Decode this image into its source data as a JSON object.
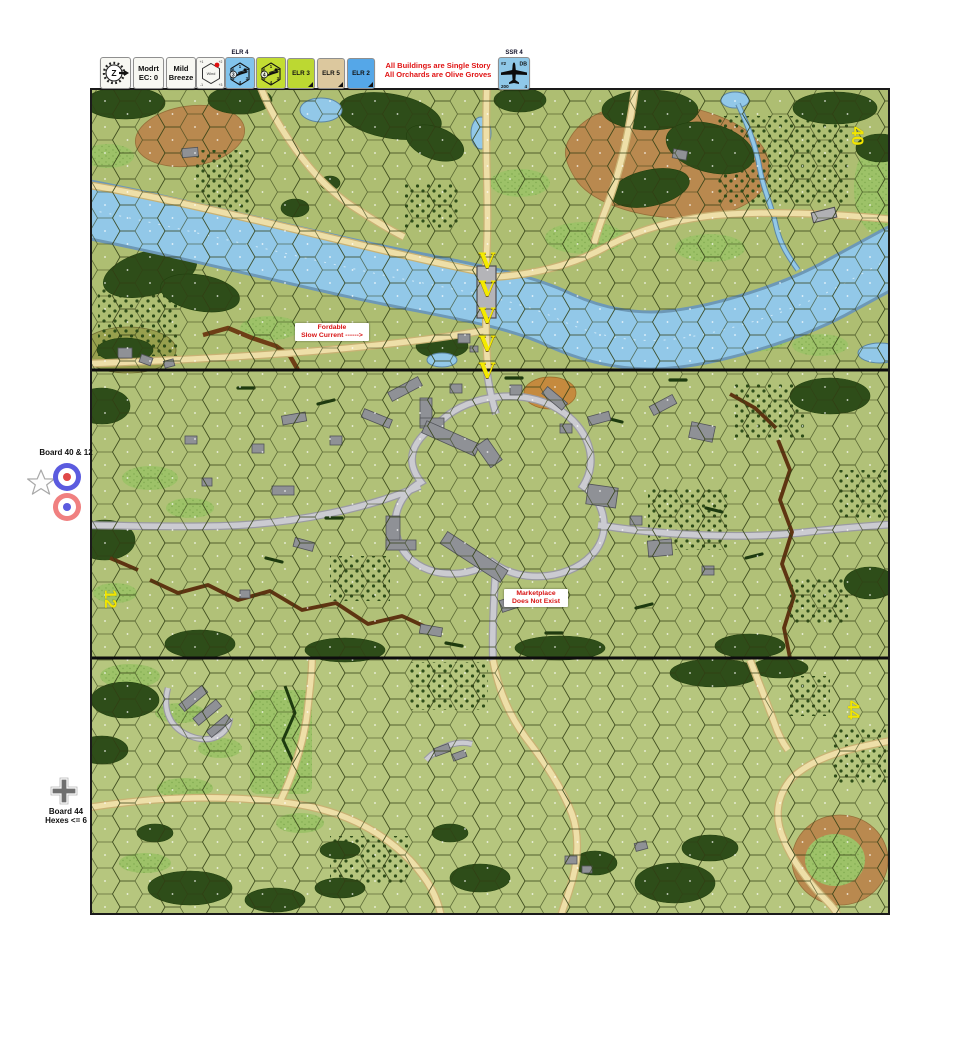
{
  "toolbar": {
    "wind_compass": {
      "letter": "Z"
    },
    "ec_counter": {
      "line1": "Modrt",
      "line2": "EC: 0"
    },
    "breeze_counter": {
      "line1": "Mild",
      "line2": "Breeze"
    },
    "wind_dial": {
      "label": "Wind",
      "ticks": [
        "+1",
        "+2",
        "+3",
        "-1"
      ]
    },
    "snipers": [
      {
        "label_above": "ELR 4",
        "san": "3",
        "color": "#82c4ec",
        "die": [
          "1",
          "2",
          "3",
          "4",
          "5",
          "6"
        ]
      },
      {
        "label_above": "",
        "san": "4",
        "color": "#c3dd33",
        "die": [
          "1",
          "2",
          "3",
          "4",
          "5",
          "6"
        ]
      }
    ],
    "elr_counters": [
      {
        "label": "ELR 3",
        "color": "#bcd832"
      },
      {
        "label": "ELR 5",
        "color": "#dcc89e"
      },
      {
        "label": "ELR 2",
        "color": "#55a7e8"
      }
    ],
    "notice": {
      "line1": "All Buildings are Single Story",
      "line2": "All Orchards are Olive Groves",
      "color": "#e01212"
    },
    "aircraft": {
      "label_above": "SSR 4",
      "top_left": "#2",
      "top_right": "DB",
      "bottom_left": "200",
      "bottom_right": "4",
      "color": "#8fc8e8"
    }
  },
  "annotations": {
    "boards_label": "Board 40 & 12",
    "board44_line1": "Board 44",
    "board44_line2": "Hexes <= 6"
  },
  "map": {
    "board_numbers": [
      "40",
      "12",
      "44"
    ],
    "fordable": {
      "line1": "Fordable",
      "line2": "Slow Current  ------>"
    },
    "marketplace": {
      "line1": "Marketplace",
      "line2": "Does Not Exist"
    },
    "current_arrow": "V",
    "terrain_colors": {
      "board_green": "#b1c178",
      "river_blue": "#92c8e8",
      "road_tan": "#eedfa8",
      "village_road_gray": "#cbcbd1",
      "woods_green": "#2e4d19",
      "hill_brown": "#b9894f",
      "board_number_yellow": "#f2e600"
    }
  }
}
